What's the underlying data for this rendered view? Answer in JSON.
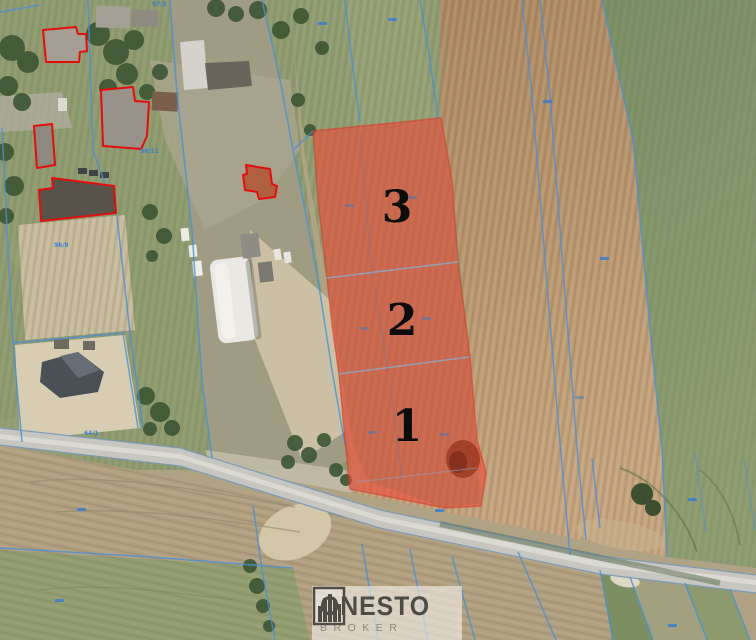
{
  "branding": {
    "name": "ONESTO",
    "subtitle": "BROKER"
  },
  "parcels": [
    {
      "number": "3"
    },
    {
      "number": "2"
    },
    {
      "number": "1"
    }
  ],
  "parcel_refs": [
    {
      "text": "97/5"
    },
    {
      "text": "98/11"
    },
    {
      "text": "96/9"
    },
    {
      "text": "64/1"
    }
  ],
  "colors": {
    "highlight_red": "#f04837",
    "cadastral_blue": "#4a90d8",
    "building_outline_red": "#e40d0d",
    "logo_dark": "#4e4c44",
    "logo_light": "#8b897e"
  }
}
